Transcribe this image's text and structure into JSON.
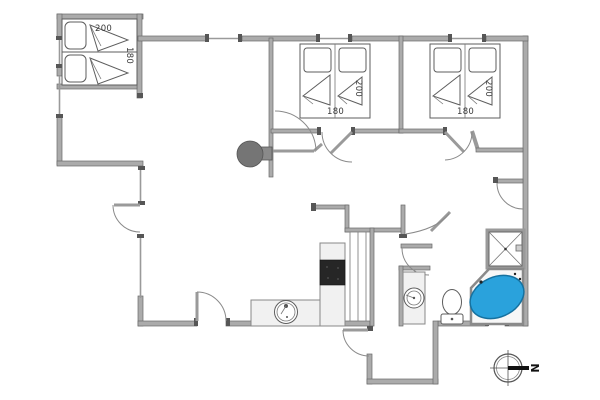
{
  "plan_title": "holiday-house-floor-plan",
  "rooms": {
    "bedroom_annex": {
      "labels": {
        "length": "200",
        "width": "180"
      }
    },
    "bedroom_middle": {
      "labels": {
        "width": "180",
        "length": "200"
      }
    },
    "bedroom_right": {
      "labels": {
        "width": "180",
        "length": "200"
      }
    }
  },
  "compass": {
    "north": "N"
  },
  "colors": {
    "wall": "#ababab",
    "wall_edge": "#6a6a6a",
    "spa_fill": "#2aa2dc",
    "spa_stroke": "#16719f",
    "cooktop_fill": "#262626",
    "wood_stove_fill": "#757575",
    "fixture_stroke": "#5d5d5d",
    "counter_fill": "#f1f1f1"
  }
}
